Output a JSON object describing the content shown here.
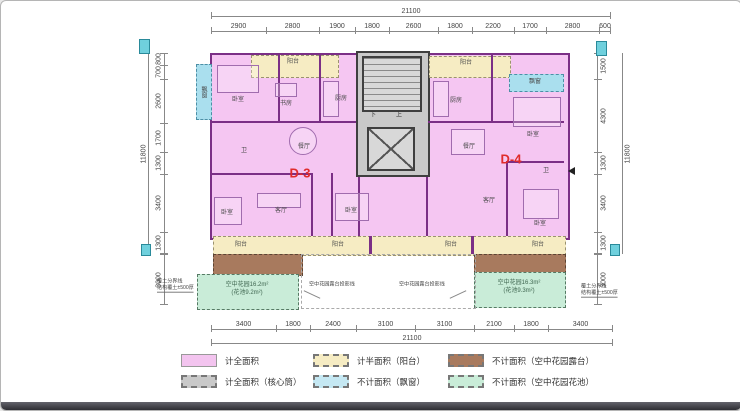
{
  "units": {
    "left": "D-3",
    "right": "D-4"
  },
  "stairs": {
    "down": "下",
    "up": "上"
  },
  "dims": {
    "top": {
      "total": "21100",
      "segments": [
        "2900",
        "2800",
        "1900",
        "1800",
        "2600",
        "1800",
        "2200",
        "1700",
        "2800",
        "600"
      ]
    },
    "bottom": {
      "total": "21100",
      "segments": [
        "3400",
        "1800",
        "2400",
        "3100",
        "3100",
        "2100",
        "1800",
        "3400"
      ]
    },
    "left": {
      "total": "11800",
      "segments": [
        "800",
        "700",
        "2600",
        "1700",
        "1300",
        "3400",
        "1300"
      ],
      "garden": "3000"
    },
    "right": {
      "total": "11800",
      "segments": [
        "1500",
        "4300",
        "1300",
        "3400",
        "1300"
      ],
      "garden": "3000"
    }
  },
  "rooms": {
    "left_bay": "飘窗",
    "left_balcony_top": "阳台",
    "left_bed1": "卧室",
    "left_study": "书房",
    "left_kitchen": "厨房",
    "left_bath": "卫",
    "left_dining": "餐厅",
    "left_bed2": "卧室",
    "left_living": "客厅",
    "left_bed3": "卧室",
    "left_balcony_b1": "阳台",
    "left_balcony_b2": "阳台",
    "right_balcony_top": "阳台",
    "right_kitchen": "厨房",
    "right_bed1": "卧室",
    "right_bay": "飘窗",
    "right_dining": "餐厅",
    "right_bath": "卫",
    "right_living": "客厅",
    "right_bed2": "卧室",
    "right_balcony_b1": "阳台",
    "right_balcony_b2": "阳台"
  },
  "annotations": {
    "garden_left_l1": "空中花园16.2m²",
    "garden_left_l2": "(花池9.2m²)",
    "garden_right_l1": "空中花园16.3m²",
    "garden_right_l2": "(花池9.3m²)",
    "projection_left": "空中花园露台投影线",
    "projection_right": "空中花园露台投影线",
    "soil_l1": "覆土分界线",
    "soil_l2": "结构覆土±500厚"
  },
  "legend": {
    "items": [
      {
        "label": "计全面积",
        "color": "#f3c4ef",
        "border": "solid"
      },
      {
        "label": "计全面积（核心筒）",
        "color": "#c9c9c9",
        "border": "dashed"
      },
      {
        "label": "计半面积（阳台）",
        "color": "#f6ecc3",
        "border": "dashed"
      },
      {
        "label": "不计面积（飘窗）",
        "color": "#c5e8f3",
        "border": "dashed"
      },
      {
        "label": "不计面积（空中花园露台）",
        "color": "#a87a5e",
        "border": "dashed"
      },
      {
        "label": "不计面积（空中花园花池）",
        "color": "#c9ecd8",
        "border": "dashed"
      }
    ]
  },
  "colors": {
    "unit_fill": "#f5c6f2",
    "unit_wall": "#7b2f86",
    "core_fill": "#c9c9c9",
    "balcony_fill": "#f6ecc3",
    "bay_fill": "#aadfee",
    "terrace_fill": "#a87a5e",
    "garden_fill": "#c9ecd8",
    "unit_label": "#e02b2b",
    "dim_line": "#888"
  }
}
